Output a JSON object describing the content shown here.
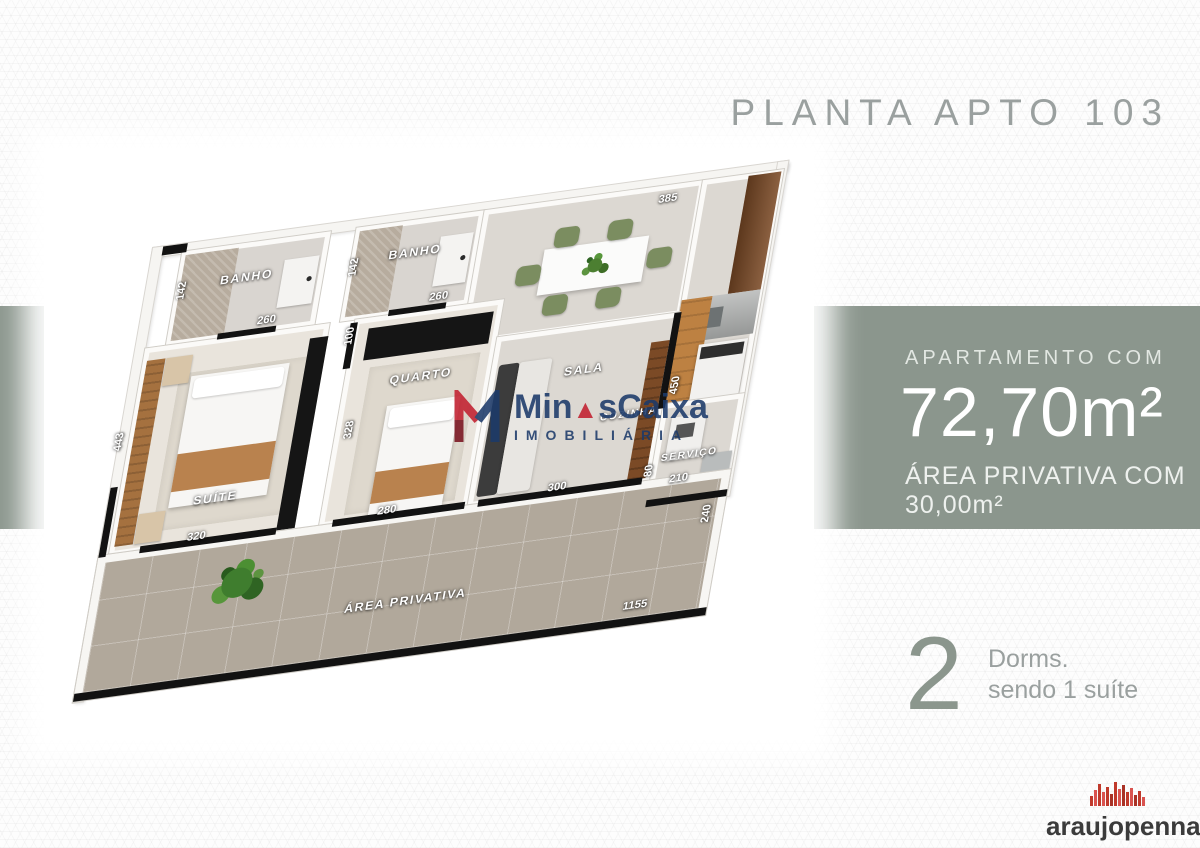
{
  "header": {
    "title": "PLANTA APTO 103"
  },
  "band": {
    "heading": "APARTAMENTO COM",
    "area": "72,70m²",
    "subheading": "ÁREA PRIVATIVA COM 30,00m²",
    "color": "#8b968d"
  },
  "dorms": {
    "count": "2",
    "line1": "Dorms.",
    "line2": "sendo 1 suíte"
  },
  "watermark": {
    "brand_pre": "Min",
    "brand_tri": "▲",
    "brand_post": "sCaixa",
    "sub": "IMOBILIÁRIA",
    "navy": "#1c3a6a",
    "red": "#c22030"
  },
  "logo": {
    "text": "araujopenna",
    "red": "#c0392b"
  },
  "floorplan": {
    "labels": {
      "banho1": "BANHO",
      "banho2": "BANHO",
      "suite": "SUÍTE",
      "quarto": "QUARTO",
      "sala": "SALA",
      "cozinha": "COZINHA",
      "servico": "SERVIÇO",
      "terrace": "ÁREA PRIVATIVA"
    },
    "dims": {
      "banho1_h": "142",
      "banho1_w": "260",
      "banho2_h": "142",
      "banho2_w": "260",
      "suite_h": "443",
      "suite_w": "320",
      "hall_w": "100",
      "quarto_h": "328",
      "quarto_w": "280",
      "sala_w": "300",
      "dining_w": "385",
      "cozinha_h": "450",
      "servico_h": "80",
      "servico_w": "210",
      "terrace_h": "240",
      "terrace_w": "1155"
    }
  },
  "colors": {
    "band_green": "#8b968d",
    "title_gray": "#9aa09f",
    "terrace_taupe": "#b1a89b"
  }
}
